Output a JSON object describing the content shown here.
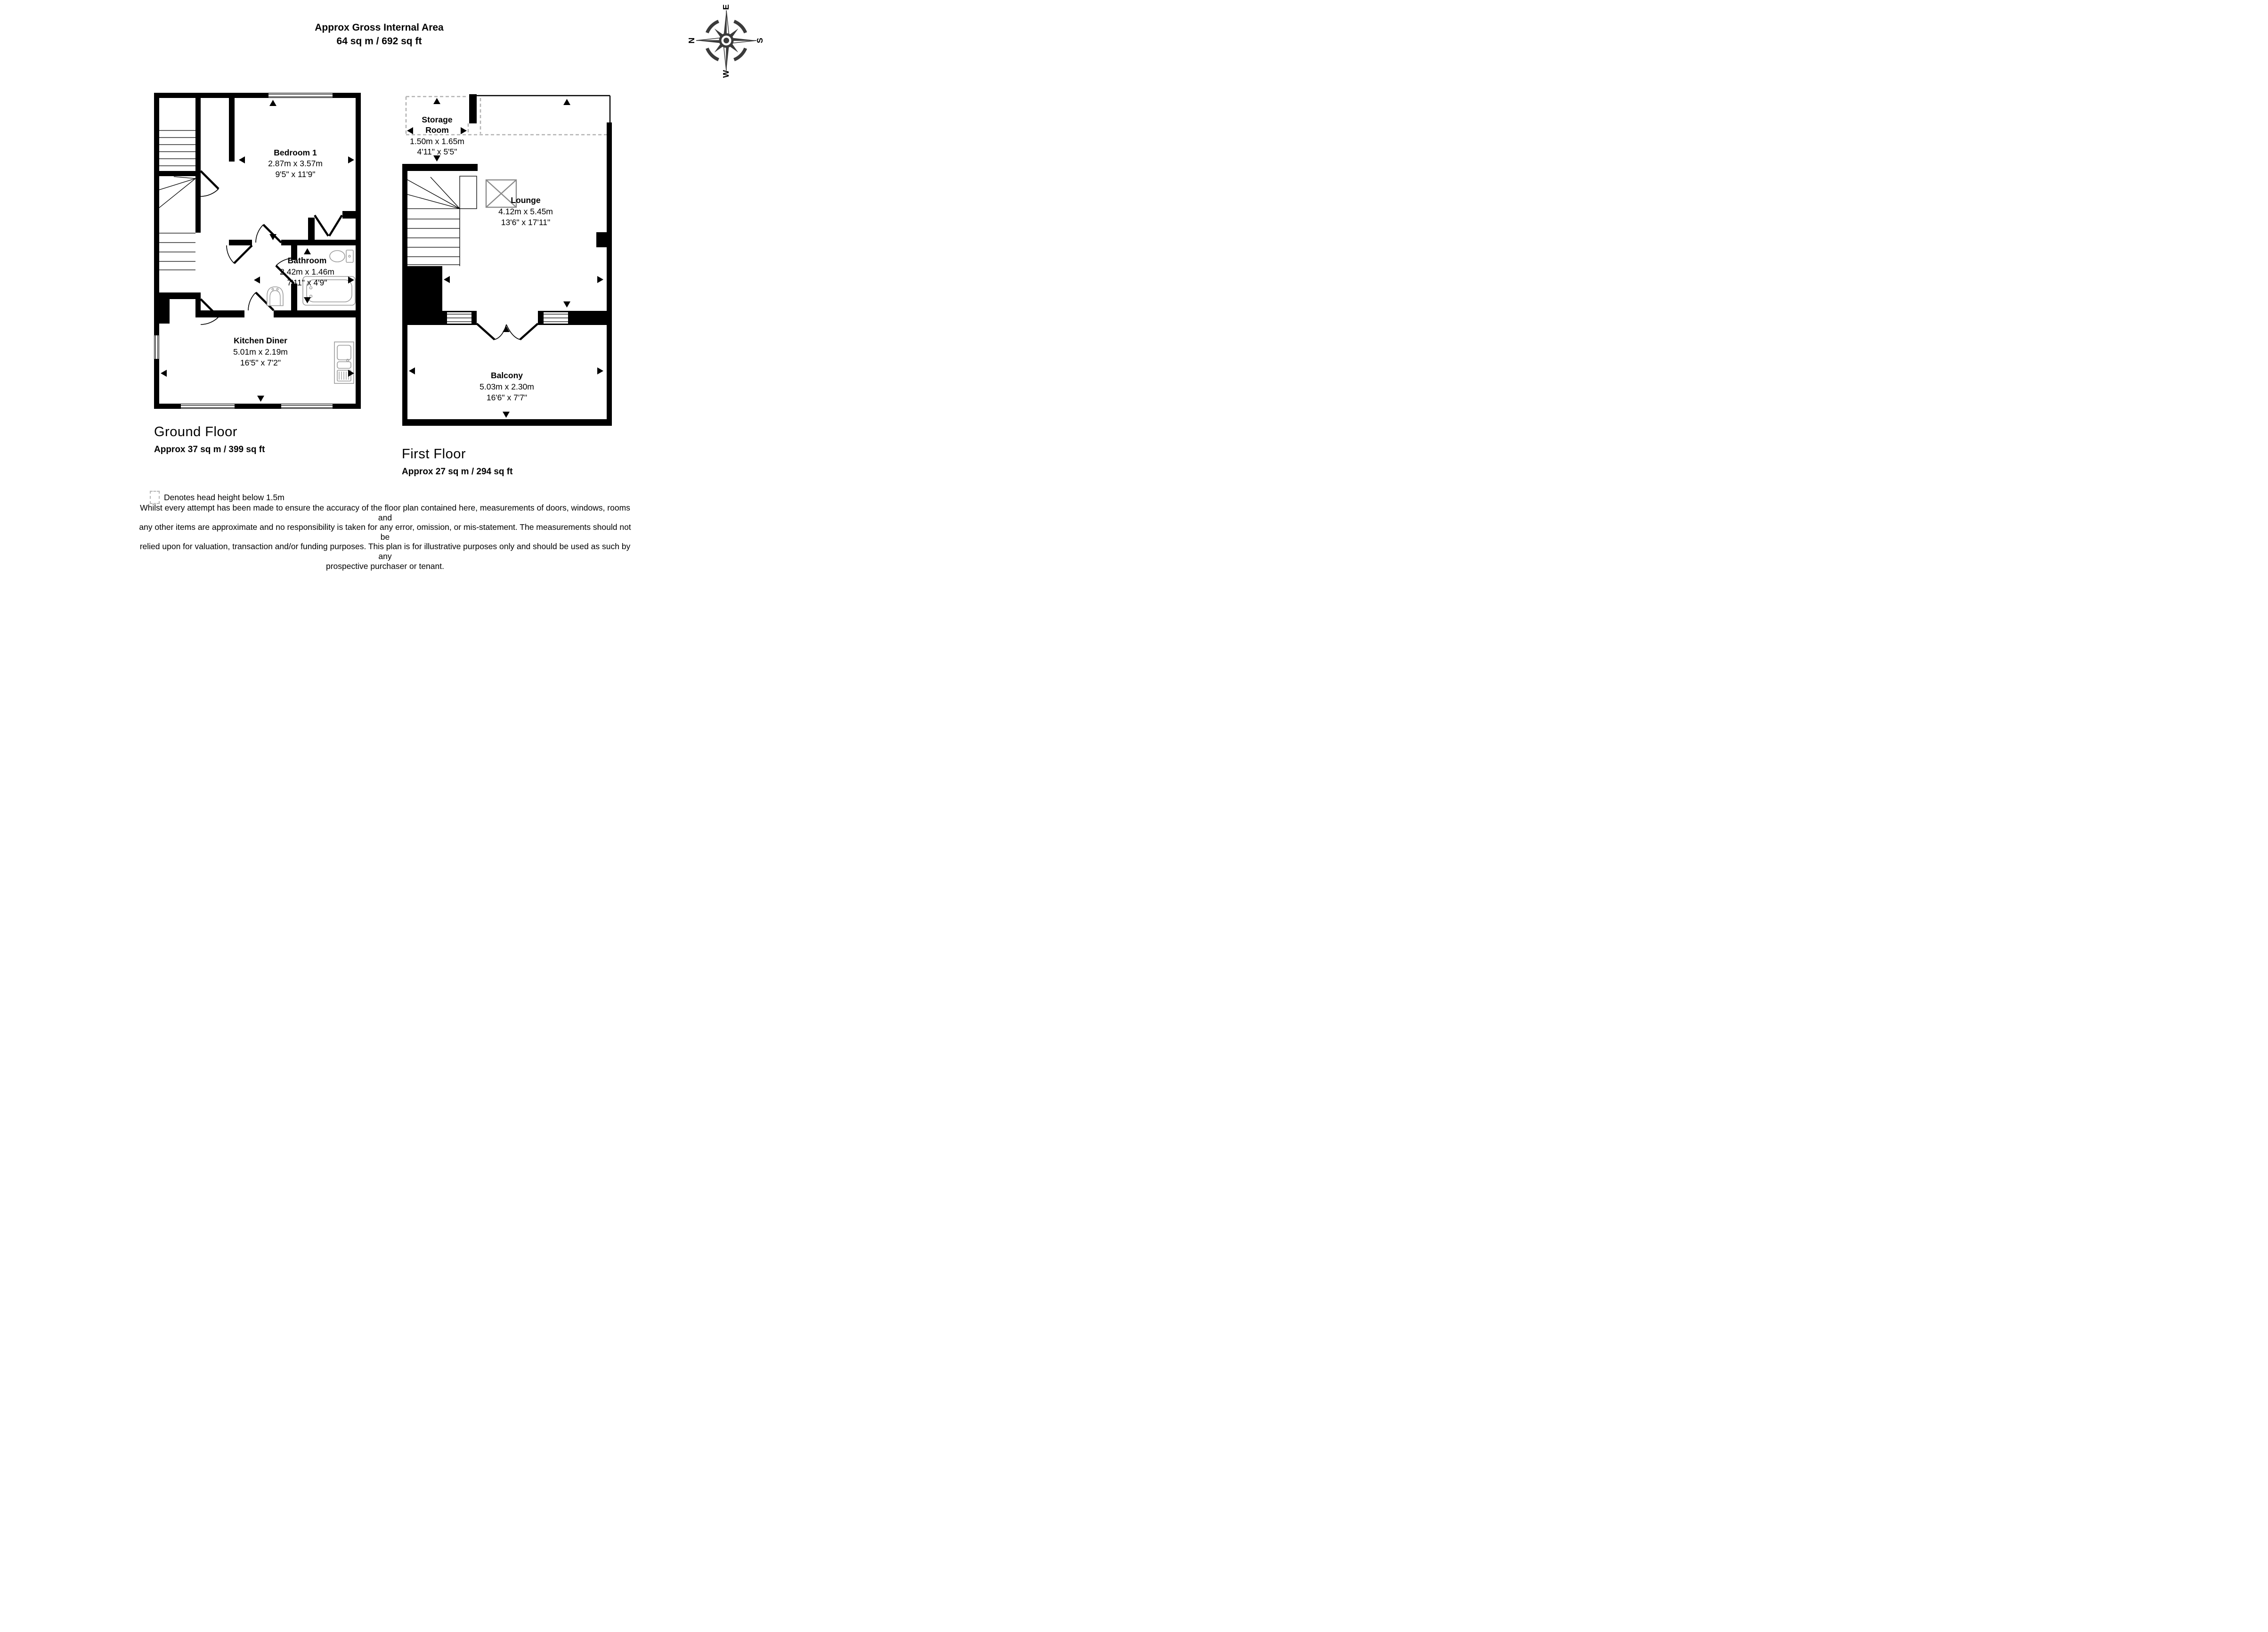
{
  "header": {
    "title_line1": "Approx Gross Internal Area",
    "title_line2": "64 sq m / 692 sq ft"
  },
  "compass": {
    "n": "N",
    "e": "E",
    "s": "S",
    "w": "W"
  },
  "ground_floor": {
    "caption": "Ground Floor",
    "area": "Approx 37 sq m / 399 sq ft",
    "rooms": [
      {
        "name": "Bedroom 1",
        "dim_metric": "2.87m x 3.57m",
        "dim_imperial": "9'5\" x 11'9\""
      },
      {
        "name": "Bathroom",
        "dim_metric": "2.42m x 1.46m",
        "dim_imperial": "7'11\" x 4'9\""
      },
      {
        "name": "Kitchen Diner",
        "dim_metric": "5.01m x 2.19m",
        "dim_imperial": "16'5\" x 7'2\""
      }
    ]
  },
  "first_floor": {
    "caption": "First Floor",
    "area": "Approx 27 sq m / 294 sq ft",
    "rooms": [
      {
        "name_line1": "Storage",
        "name_line2": "Room",
        "dim_metric": "1.50m x 1.65m",
        "dim_imperial": "4'11\" x 5'5\""
      },
      {
        "name": "Lounge",
        "dim_metric": "4.12m x 5.45m",
        "dim_imperial": "13'6\" x 17'11\""
      },
      {
        "name": "Balcony",
        "dim_metric": "5.03m x 2.30m",
        "dim_imperial": "16'6\" x 7'7\""
      }
    ]
  },
  "legend": {
    "text": "Denotes head height below 1.5m"
  },
  "disclaimer": {
    "lines": [
      "Whilst every attempt has been made to ensure the accuracy of the floor plan contained here, measurements of doors, windows, rooms and",
      "any other items are approximate and no responsibility is taken for any error, omission, or mis-statement. The measurements should not be",
      "relied upon for valuation, transaction and/or funding purposes. This plan is for illustrative purposes only and should be used as such by any",
      "prospective purchaser or tenant."
    ]
  },
  "colors": {
    "wall": "#000000",
    "fixture": "#9b9b9b",
    "head_height_dash": "#b3b3b3",
    "compass": "#3a3a3a"
  }
}
